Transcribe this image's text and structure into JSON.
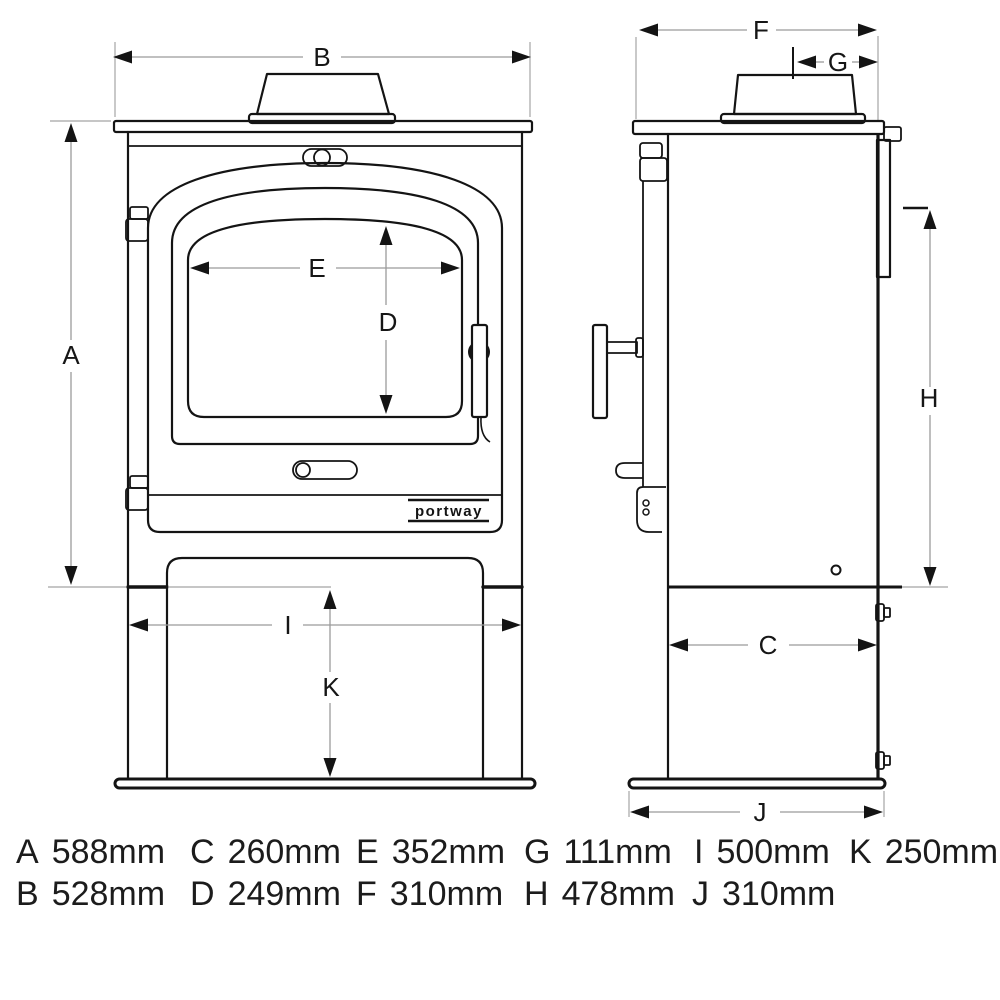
{
  "figure": {
    "description": "Stove dimension diagram, front and side elevation",
    "logo": "portway"
  },
  "labels": {
    "A": "A",
    "B": "B",
    "C": "C",
    "D": "D",
    "E": "E",
    "F": "F",
    "G": "G",
    "H": "H",
    "I": "I",
    "J": "J",
    "K": "K"
  },
  "legend": {
    "row1": [
      {
        "key": "A",
        "value": "588mm"
      },
      {
        "key": "C",
        "value": "260mm"
      },
      {
        "key": "E",
        "value": "352mm"
      },
      {
        "key": "G",
        "value": "111mm"
      },
      {
        "key": "I",
        "value": "500mm"
      },
      {
        "key": "K",
        "value": "250mm"
      }
    ],
    "row2": [
      {
        "key": "B",
        "value": "528mm"
      },
      {
        "key": "D",
        "value": "249mm"
      },
      {
        "key": "F",
        "value": "310mm"
      },
      {
        "key": "H",
        "value": "478mm"
      },
      {
        "key": "J",
        "value": "310mm"
      }
    ]
  }
}
